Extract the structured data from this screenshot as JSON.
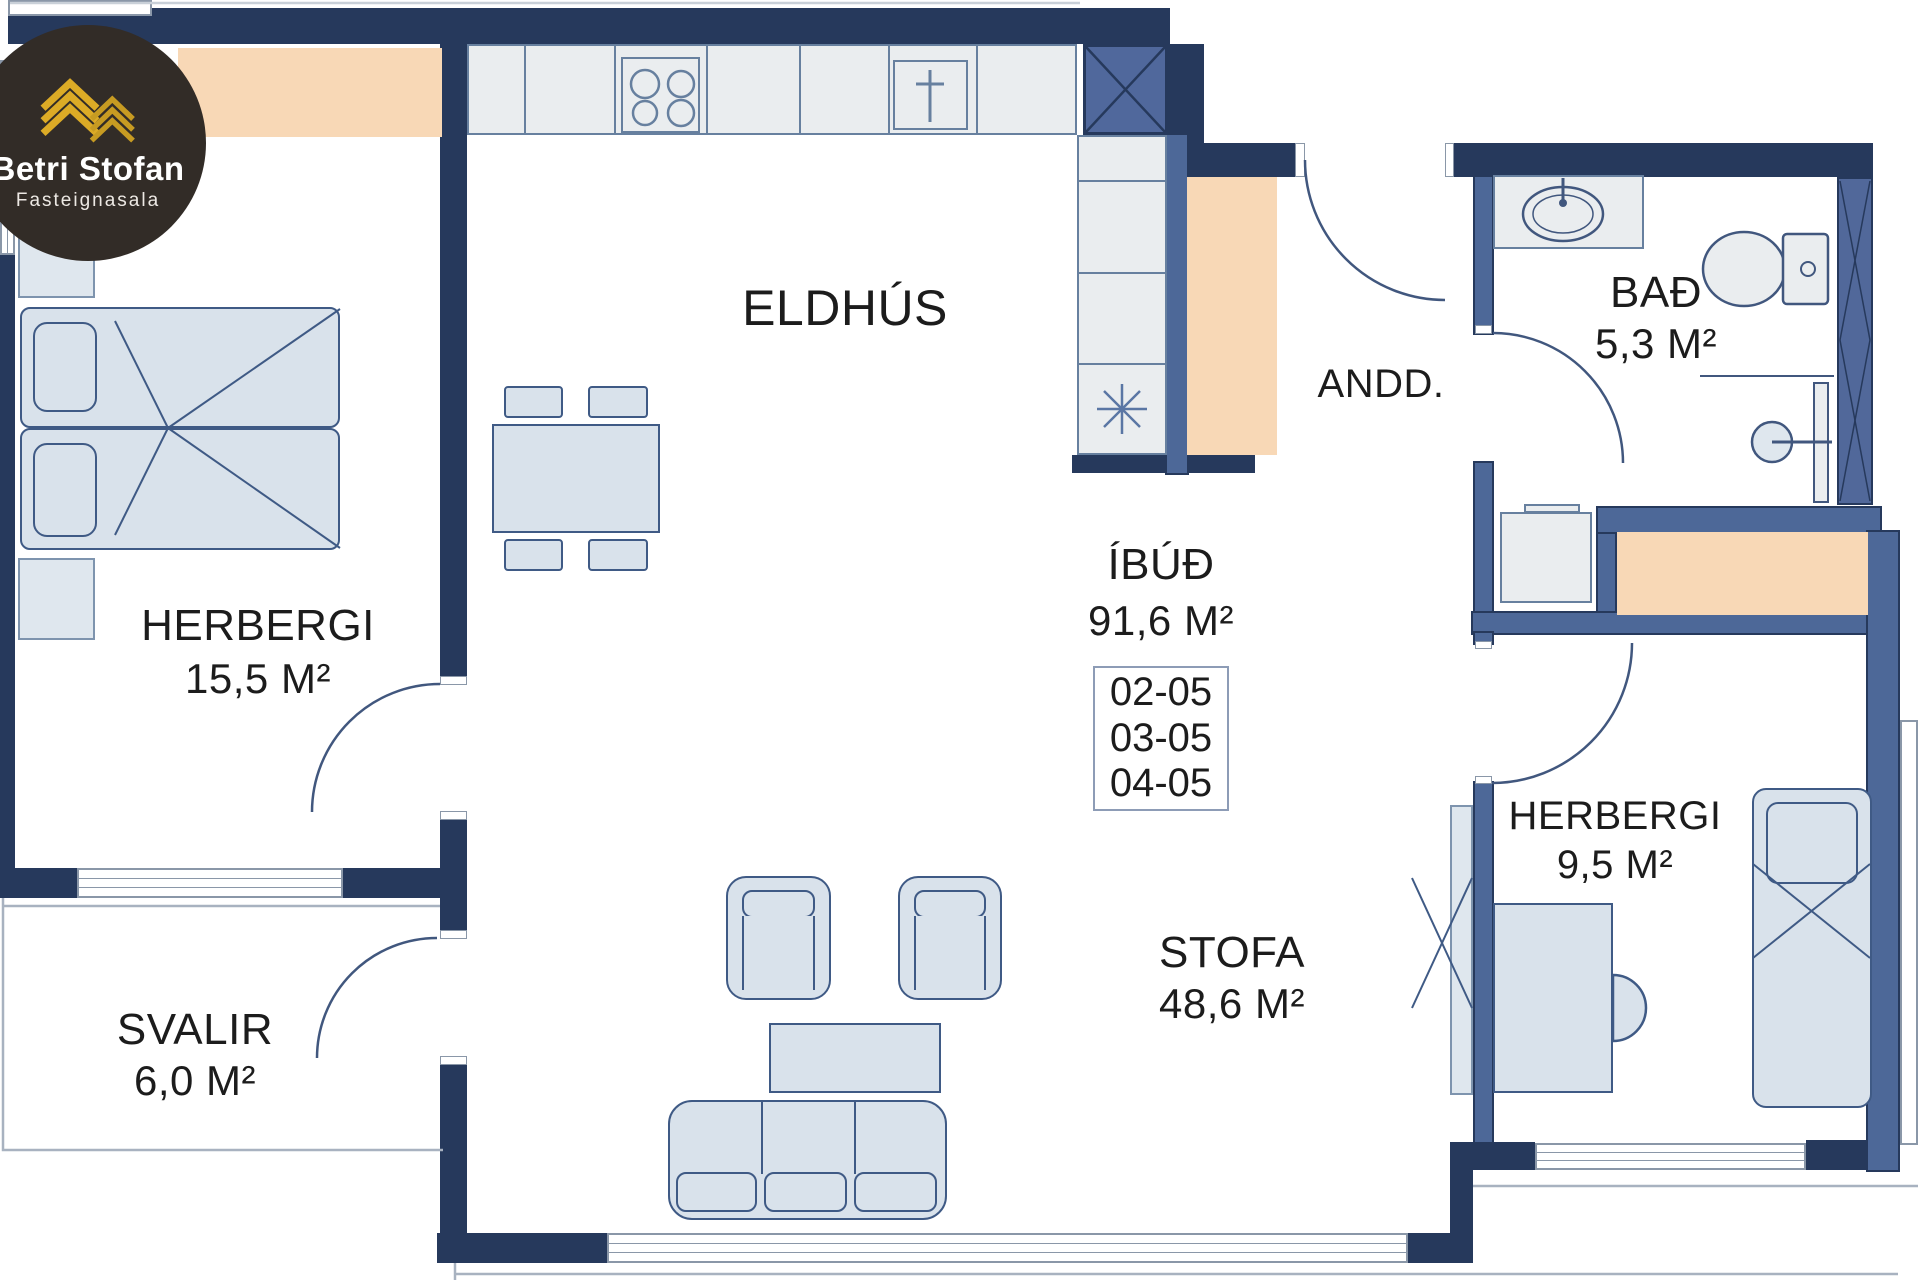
{
  "brand": {
    "name": "Betri Stofan",
    "tagline": "Fasteignasala"
  },
  "apartment": {
    "label": "ÍBÚÐ",
    "area": "91,6 M²",
    "units": [
      "02-05",
      "03-05",
      "04-05"
    ]
  },
  "rooms": {
    "kitchen": {
      "label": "ELDHÚS"
    },
    "bedroom_main": {
      "label": "HERBERGI",
      "area": "15,5 M²"
    },
    "balcony": {
      "label": "SVALIR",
      "area": "6,0 M²"
    },
    "entry": {
      "label": "ANDD."
    },
    "bath": {
      "label": "BAÐ",
      "area": "5,3 M²"
    },
    "living": {
      "label": "STOFA",
      "area": "48,6 M²"
    },
    "bedroom_second": {
      "label": "HERBERGI",
      "area": "9,5 M²"
    }
  },
  "icons": {
    "logo_building": "gold-chevron-building-icon",
    "fixtures": [
      "stove-icon",
      "kitchen-sink-icon",
      "fridge-asterisk-icon",
      "bath-sink-icon",
      "toilet-icon",
      "shower-icon",
      "washing-machine-icon"
    ]
  },
  "colors": {
    "wall_dark": "#26395C",
    "wall_medium": "#4D6898",
    "shaft_fill": "#50689C",
    "furniture_fill": "#D9E2EB",
    "furniture_outline": "#3F5A85",
    "counter_fill": "#EAEDEF",
    "wardrobe_orange": "#F8D8B6",
    "window_frame": "#8A97A8",
    "text": "#1C1C1C",
    "logo_background": "#322C27",
    "logo_gold": "#DCAB26"
  }
}
